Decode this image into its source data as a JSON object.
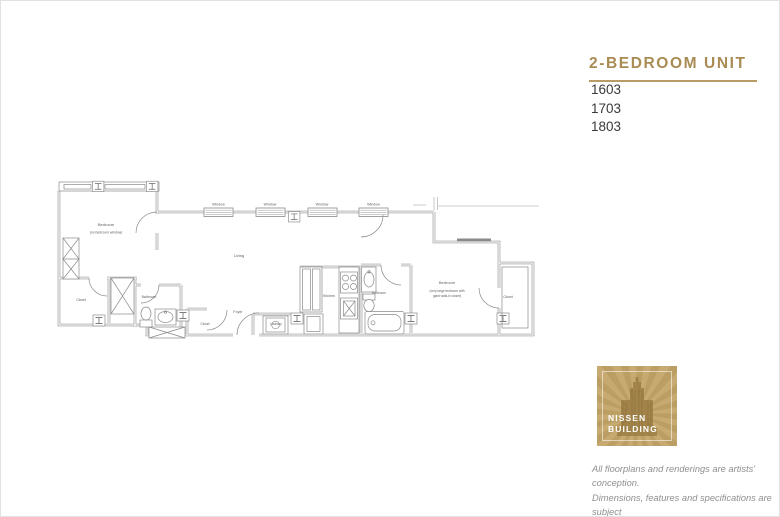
{
  "sidebar": {
    "title": "2-BEDROOM UNIT",
    "units": [
      "1603",
      "1703",
      "1803"
    ],
    "accent_color": "#a98b54"
  },
  "floorplan": {
    "windows": [
      "Window",
      "Window",
      "Window",
      "Window"
    ],
    "rooms": {
      "bedroom1": "Bedroom",
      "bedroom1_note": "(no bedroom window)",
      "closet_left": "Closet",
      "bathroom1": "Bathroom",
      "living": "Living",
      "foyer": "Foyer",
      "closet_foyer": "Closet",
      "laundry": "Laundry",
      "kitchen": "Kitchen",
      "bathroom2": "Bathroom",
      "bedroom2": "Bedroom",
      "bedroom2_note_line1": "(very large bedroom with",
      "bedroom2_note_line2": "giant walk-in closet)",
      "closet_right": "Closet"
    }
  },
  "logo": {
    "line1": "NISSEN",
    "line2": "BUILDING",
    "bg_color": "#c3a467"
  },
  "disclaimer": {
    "line1": "All floorplans and renderings are artists' conception.",
    "line2": "Dimensions, features and specifications are subject",
    "line3": "to change at the discretion of the builder."
  }
}
